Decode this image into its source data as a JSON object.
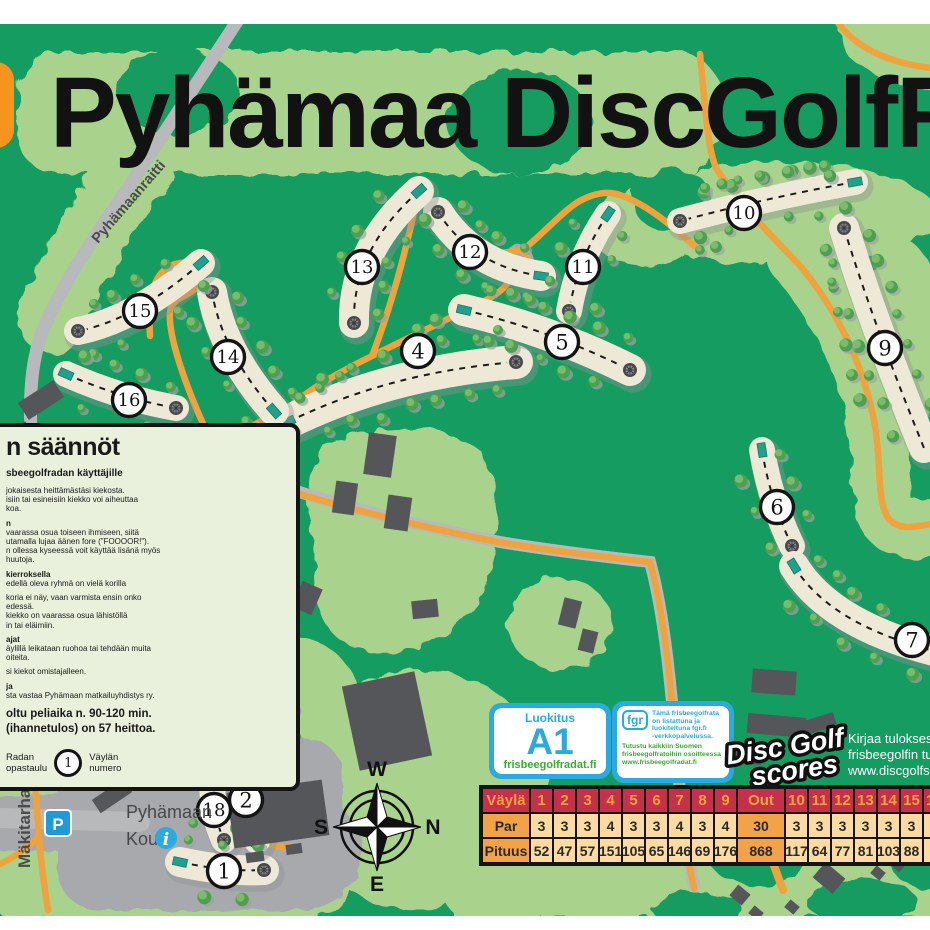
{
  "title": "Pyhämaa DiscGolfPark",
  "map": {
    "colors": {
      "forest": "#159C61",
      "light": "#A9D28D",
      "fairway": "#EEE9D6",
      "orange": "#F0A23C",
      "road": "#B7B9BB",
      "yard": "#A7A9AC",
      "building": "#55565A",
      "tee": "#21A08C",
      "accent_blue": "#29ABE2"
    },
    "roads": [
      {
        "name": "Pyhämaanraitti"
      },
      {
        "name": "Tontontie"
      },
      {
        "name": "Mäkitarhantie"
      }
    ],
    "compass": {
      "top": "W",
      "right": "N",
      "bottom": "E",
      "left": "S"
    },
    "school": {
      "line1": "Pyhämaan",
      "line2": "Koulu"
    },
    "parking": "P",
    "info": "i",
    "holes": [
      {
        "n": "1",
        "x1": 180,
        "y1": 862,
        "cx": 225,
        "cy": 872,
        "x2": 264,
        "y2": 870,
        "w": 30,
        "bx": 224,
        "by": 871,
        "tee": true,
        "bk": "e"
      },
      {
        "n": "2",
        "x1": 257,
        "y1": 841,
        "cx": 268,
        "cy": 806,
        "x2": 263,
        "y2": 773,
        "w": 26,
        "bx": 246,
        "by": 800,
        "tee": true,
        "bk": "e"
      },
      {
        "n": "3",
        "x1": 261,
        "y1": 670,
        "cx": 268,
        "cy": 710,
        "x2": 272,
        "y2": 748,
        "w": 24,
        "bx": 259,
        "by": 712,
        "tee": true,
        "bk": "e"
      },
      {
        "n": "4",
        "x1": 288,
        "y1": 422,
        "cx": 390,
        "cy": 372,
        "x2": 516,
        "y2": 362,
        "w": 34,
        "bx": 418,
        "by": 351,
        "tee": true,
        "bk": "e"
      },
      {
        "n": "5",
        "x1": 464,
        "y1": 310,
        "cx": 550,
        "cy": 330,
        "x2": 630,
        "y2": 370,
        "w": 32,
        "bx": 562,
        "by": 342,
        "tee": true,
        "bk": "e"
      },
      {
        "n": "6",
        "x1": 762,
        "y1": 450,
        "cx": 770,
        "cy": 500,
        "x2": 792,
        "y2": 546,
        "w": 26,
        "bx": 777,
        "by": 507,
        "tee": true,
        "bk": "e"
      },
      {
        "n": "7",
        "x1": 794,
        "y1": 566,
        "cx": 830,
        "cy": 625,
        "x2": 938,
        "y2": 652,
        "w": 30,
        "bx": 912,
        "by": 640,
        "tee": true,
        "bk": null
      },
      {
        "n": "9",
        "x1": 844,
        "y1": 228,
        "cx": 872,
        "cy": 320,
        "x2": 924,
        "y2": 448,
        "w": 30,
        "bx": 885,
        "by": 348,
        "tee": false,
        "bk": "s"
      },
      {
        "n": "10",
        "x1": 855,
        "y1": 182,
        "cx": 770,
        "cy": 197,
        "x2": 680,
        "y2": 221,
        "w": 26,
        "bx": 744,
        "by": 213,
        "tee": true,
        "bk": "e"
      },
      {
        "n": "11",
        "x1": 608,
        "y1": 214,
        "cx": 578,
        "cy": 258,
        "x2": 569,
        "y2": 311,
        "w": 26,
        "bx": 583,
        "by": 267,
        "tee": true,
        "bk": "e"
      },
      {
        "n": "12",
        "x1": 541,
        "y1": 276,
        "cx": 472,
        "cy": 266,
        "x2": 438,
        "y2": 212,
        "w": 30,
        "bx": 470,
        "by": 252,
        "tee": true,
        "bk": "e"
      },
      {
        "n": "13",
        "x1": 419,
        "y1": 191,
        "cx": 352,
        "cy": 250,
        "x2": 354,
        "y2": 323,
        "w": 30,
        "bx": 362,
        "by": 267,
        "tee": true,
        "bk": "e"
      },
      {
        "n": "14",
        "x1": 274,
        "y1": 411,
        "cx": 222,
        "cy": 352,
        "x2": 212,
        "y2": 292,
        "w": 30,
        "bx": 228,
        "by": 357,
        "tee": true,
        "bk": "e"
      },
      {
        "n": "15",
        "x1": 201,
        "y1": 263,
        "cx": 135,
        "cy": 320,
        "x2": 78,
        "y2": 331,
        "w": 28,
        "bx": 140,
        "by": 311,
        "tee": true,
        "bk": "e"
      },
      {
        "n": "16",
        "x1": 66,
        "y1": 374,
        "cx": 120,
        "cy": 398,
        "x2": 176,
        "y2": 408,
        "w": 26,
        "bx": 129,
        "by": 400,
        "tee": true,
        "bk": "e"
      },
      {
        "n": "17",
        "x1": 242,
        "y1": 663,
        "cx": 232,
        "cy": 716,
        "x2": 192,
        "y2": 739,
        "w": 26,
        "bx": 217,
        "by": 712,
        "tee": true,
        "bk": "e"
      },
      {
        "n": "18",
        "x1": 216,
        "y1": 757,
        "cx": 206,
        "cy": 800,
        "x2": 224,
        "y2": 840,
        "w": 26,
        "bx": 214,
        "by": 810,
        "tee": true,
        "bk": "e"
      }
    ]
  },
  "rules": {
    "title": "n säännöt",
    "subtitle": "sbeegolfradan käyttäjille",
    "lines": [
      {
        "t": "jokaisesta heittämästäsi kiekosta.",
        "b": 0
      },
      {
        "t": "isiin tai esineisiin kiekko voi aiheuttaa",
        "b": 0
      },
      {
        "t": "koa.",
        "b": 0
      },
      {
        "t": "",
        "b": 0
      },
      {
        "t": "n",
        "b": 1
      },
      {
        "t": "vaarassa osua toiseen ihmiseen, siitä",
        "b": 0
      },
      {
        "t": "utamalla lujaa äänen fore (\"FOOOOR!\").",
        "b": 0
      },
      {
        "t": "n ollessa kyseessä voit käyttää lisänä myös",
        "b": 0
      },
      {
        "t": "huutoja.",
        "b": 0
      },
      {
        "t": "",
        "b": 0
      },
      {
        "t": "kierroksella",
        "b": 1
      },
      {
        "t": "edellä oleva ryhmä on vielä korilla",
        "b": 0
      },
      {
        "t": "",
        "b": 0
      },
      {
        "t": "koria ei näy, vaan varmista ensin onko",
        "b": 0
      },
      {
        "t": "edessä.",
        "b": 0
      },
      {
        "t": "kiekko on vaarassa osua lähistöllä",
        "b": 0
      },
      {
        "t": "in tai eläimiin.",
        "b": 0
      },
      {
        "t": "",
        "b": 0
      },
      {
        "t": "ajat",
        "b": 1
      },
      {
        "t": "äylillä leikataan ruohoa tai tehdään muita",
        "b": 0
      },
      {
        "t": "oiteita.",
        "b": 0
      },
      {
        "t": "",
        "b": 0
      },
      {
        "t": "si kiekot omistajalleen.",
        "b": 0
      },
      {
        "t": "",
        "b": 0
      },
      {
        "t": "ja",
        "b": 1
      },
      {
        "t": "sta vastaa Pyhämaan matkailuyhdistys ry.",
        "b": 0
      }
    ],
    "summary": [
      "oltu peliaika n. 90-120 min.",
      "(ihannetulos) on 57 heittoa."
    ],
    "legend": {
      "l1": "Radan",
      "l2": "opastaulu",
      "num": "1",
      "r1": "Väylän",
      "r2": "numero"
    }
  },
  "badges": {
    "luokitus": {
      "title": "Luokitus",
      "value": "A1",
      "site": "frisbeegolfradat.fi"
    },
    "fgr": {
      "bubble": "fgr",
      "lines1": [
        "Tämä frisbeegolfrata",
        "on listattuna ja",
        "luokiteltuna fgr.fi",
        "-verkkopalvelussa."
      ],
      "lines2": [
        "Tutustu kaikkiin Suomen",
        "frisbeegolfratoihin osoitteessa",
        "www.frisbeegolfradat.fi"
      ]
    },
    "scores": {
      "line1": "Disc Golf",
      "line2": "scores"
    },
    "kirjaa": [
      "Kirjaa tuloksesi v",
      "frisbeegolfin tulo",
      "www.discgolfsco"
    ]
  },
  "scorecard": {
    "vayla": [
      "Väylä",
      "1",
      "2",
      "3",
      "4",
      "5",
      "6",
      "7",
      "8",
      "9",
      "Out",
      "10",
      "11",
      "12",
      "13",
      "14",
      "15",
      "16"
    ],
    "par": [
      "Par",
      "3",
      "3",
      "3",
      "4",
      "3",
      "3",
      "4",
      "3",
      "4",
      "30",
      "3",
      "3",
      "3",
      "3",
      "3",
      "3",
      "3"
    ],
    "pituus": [
      "Pituus",
      "52",
      "47",
      "57",
      "151",
      "105",
      "65",
      "146",
      "69",
      "176",
      "868",
      "117",
      "64",
      "77",
      "81",
      "103",
      "88",
      "8"
    ]
  }
}
